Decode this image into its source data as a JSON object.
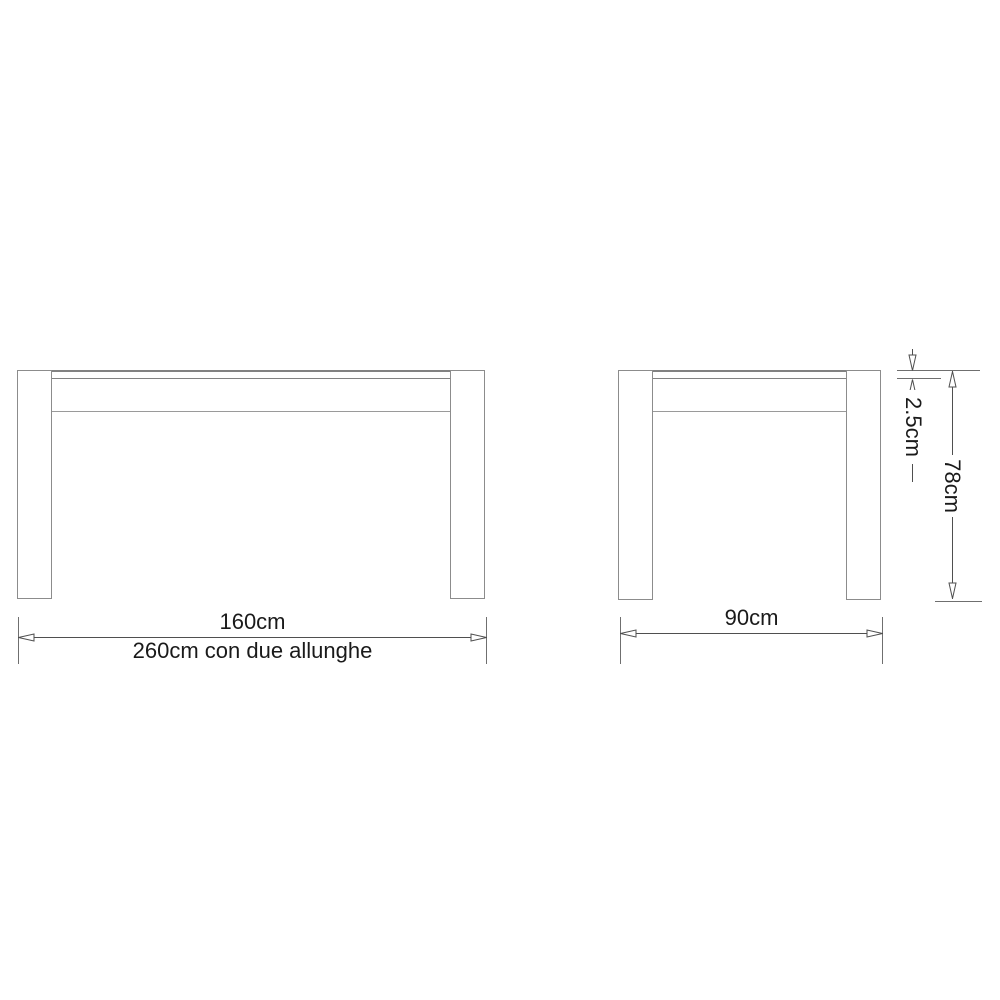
{
  "diagram": {
    "kind": "furniture-technical-drawing",
    "subject": "extendable table, front and side elevations",
    "front_view": {
      "name": "front-elevation",
      "dim_width": {
        "label": "160cm"
      },
      "dim_width_extended": {
        "label": "260cm con due allunghe"
      }
    },
    "side_view": {
      "name": "side-elevation",
      "dim_depth": {
        "label": "90cm"
      },
      "dim_top_thickness": {
        "label": "2.5cm"
      },
      "dim_height": {
        "label": "78cm"
      }
    },
    "colors": {
      "background": "#ffffff",
      "outline": "#8c8c8c",
      "dimension_line": "#4f4f4f",
      "label_text": "#1a1a1a"
    }
  }
}
